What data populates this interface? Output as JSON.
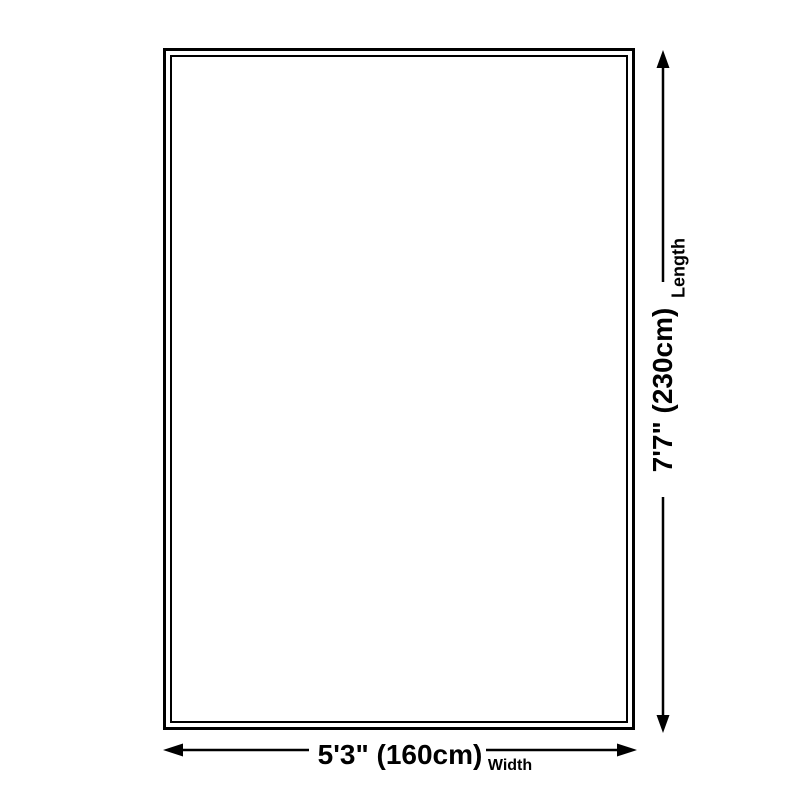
{
  "diagram": {
    "background_color": "#ffffff",
    "line_color": "#000000",
    "length": {
      "label": "Length",
      "value": "7'7\" (230cm)"
    },
    "width": {
      "label": "Width",
      "value": "5'3\" (160cm)"
    }
  }
}
